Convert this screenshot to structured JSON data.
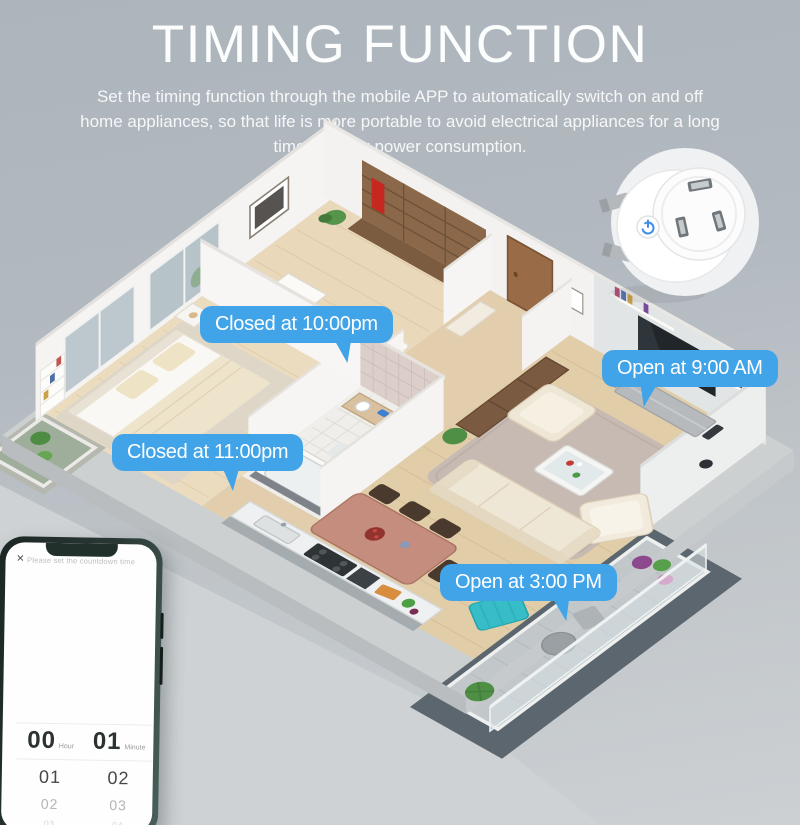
{
  "header": {
    "title": "TIMING FUNCTION",
    "subtitle": "Set the timing function through the mobile APP to automatically switch on and off home appliances, so that life is more portable to avoid electrical appliances for a long time standby power consumption."
  },
  "callouts": [
    {
      "label": "Closed at 10:00pm",
      "target": "bedroom-device"
    },
    {
      "label": "Open at 9:00 AM",
      "target": "living-room-tv"
    },
    {
      "label": "Closed at 11:00pm",
      "target": "bedroom-2-bed"
    },
    {
      "label": "Open at 3:00 PM",
      "target": "lounge-chair-area"
    }
  ],
  "phone": {
    "close_icon": "×",
    "instruction": "Please set the countdown time",
    "picker": {
      "columns": [
        {
          "label": "Hour",
          "selected": "00",
          "below": [
            "01",
            "02",
            "03"
          ]
        },
        {
          "label": "Minute",
          "selected": "01",
          "below": [
            "02",
            "03",
            "04"
          ]
        }
      ]
    }
  },
  "plug": {
    "icon": "power-icon"
  },
  "colors": {
    "accent_blue": "#41a3e8",
    "bubble_text": "#ffffff",
    "background_top": "#adb5bc",
    "background_bottom": "#ccd0d3",
    "plug_button_blue": "#3e8ee8"
  }
}
